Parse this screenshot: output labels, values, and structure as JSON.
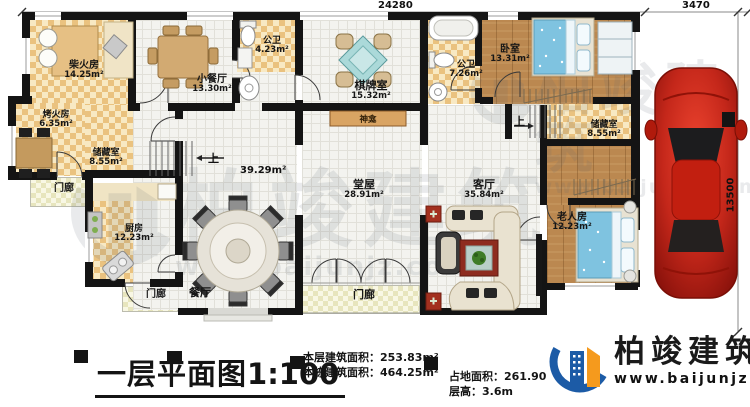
{
  "dimensions": {
    "top": "24280",
    "top_right": "3470",
    "right": "13500"
  },
  "rooms": [
    {
      "name": "柴火房",
      "area": "14.25m²"
    },
    {
      "name": "烤火房",
      "area": "6.35m²"
    },
    {
      "name": "储藏室",
      "area": "8.55m²"
    },
    {
      "name": "门廊",
      "area": ""
    },
    {
      "name": "厨房",
      "area": "12.23m²"
    },
    {
      "name": "门廊",
      "area": ""
    },
    {
      "name": "餐厅",
      "area": ""
    },
    {
      "name": "门廊",
      "area": ""
    },
    {
      "name": "小餐厅",
      "area": "13.30m²"
    },
    {
      "name": "公卫",
      "area": "4.23m²"
    },
    {
      "name": "棋牌室",
      "area": "15.32m²"
    },
    {
      "name": "神龛",
      "area": ""
    },
    {
      "name": "堂屋",
      "area": "28.91m²"
    },
    {
      "name": "公卫",
      "area": "7.26m²"
    },
    {
      "name": "卧室",
      "area": "13.31m²"
    },
    {
      "name": "储藏室",
      "area": "8.55m²"
    },
    {
      "name": "客厅",
      "area": "35.84m²"
    },
    {
      "name": "老人房",
      "area": "12.23m²"
    }
  ],
  "stairs": {
    "up_left": "上",
    "up_right": "上",
    "hall_area": "39.29m²"
  },
  "title_block": {
    "title": "一层平面图",
    "scale": "1:100",
    "stats_left": [
      {
        "label": "本层建筑面积：",
        "value": "253.83m²"
      },
      {
        "label": "本栋建筑面积：",
        "value": "464.25m²"
      }
    ],
    "stats_right": [
      {
        "label": "占地面积：",
        "value": "261.90"
      },
      {
        "label": "层高：",
        "value": "3.6m"
      }
    ]
  },
  "brand": {
    "name": "柏竣建筑",
    "url": "www.baijunjz.com"
  },
  "watermark": {
    "text": "柏竣建筑",
    "url": "www.baijunjz.com"
  },
  "colors": {
    "wall": "#141414",
    "floor_tan": "#eac27f",
    "wood": "#bb8850",
    "bed_blue": "#7fc3e0",
    "car_red": "#c4271a",
    "logo_blue": "#1c5ba6",
    "logo_orange": "#f59a1d"
  }
}
